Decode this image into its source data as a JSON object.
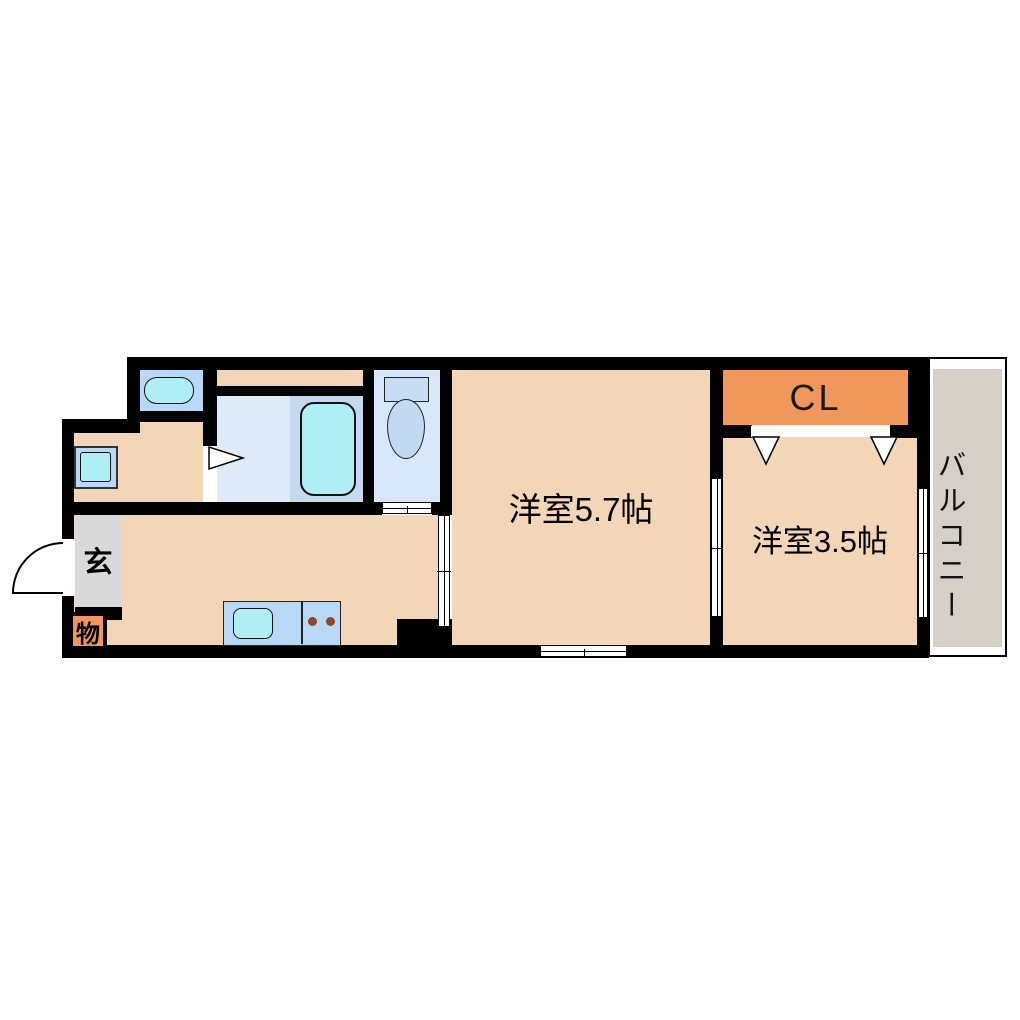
{
  "floor_plan": {
    "rooms": {
      "entrance": {
        "label": "玄"
      },
      "storage": {
        "label": "物"
      },
      "western_room_large": {
        "label": "洋室5.7帖"
      },
      "western_room_small": {
        "label": "洋室3.5帖"
      },
      "closet": {
        "label": "CL"
      },
      "balcony": {
        "label": "バルコニー"
      }
    },
    "fixtures": {
      "washing_machine_pan": "rounded-rect",
      "vanity_basin": "nested-squares",
      "bathtub": "rounded-rect",
      "toilet": "tank-and-bowl",
      "kitchen_sink": "rounded-rect",
      "stove_burners": 2,
      "entrance_door": "quarter-arc-swing",
      "closet_door": "two-triangle-folding",
      "sliding_doors": 3,
      "windows": 2
    },
    "colors": {
      "wall": "#000000",
      "floor_peach": "#F2D6B7",
      "closet_orange": "#F0985C",
      "entrance_gray": "#D9D9D9",
      "balcony_gray": "#D6CFC7",
      "wet_blue": "#B9D8F5",
      "bath_floor_blue": "#DEEAF7",
      "bathtub_zone_blue": "#C6D9F0",
      "toilet_floor_blue": "#D8E8FA",
      "toilet_fixture_blue": "#C8DDF3",
      "fixture_cyan": "#AFEEF5",
      "burner_brown": "#8A4A28"
    }
  }
}
